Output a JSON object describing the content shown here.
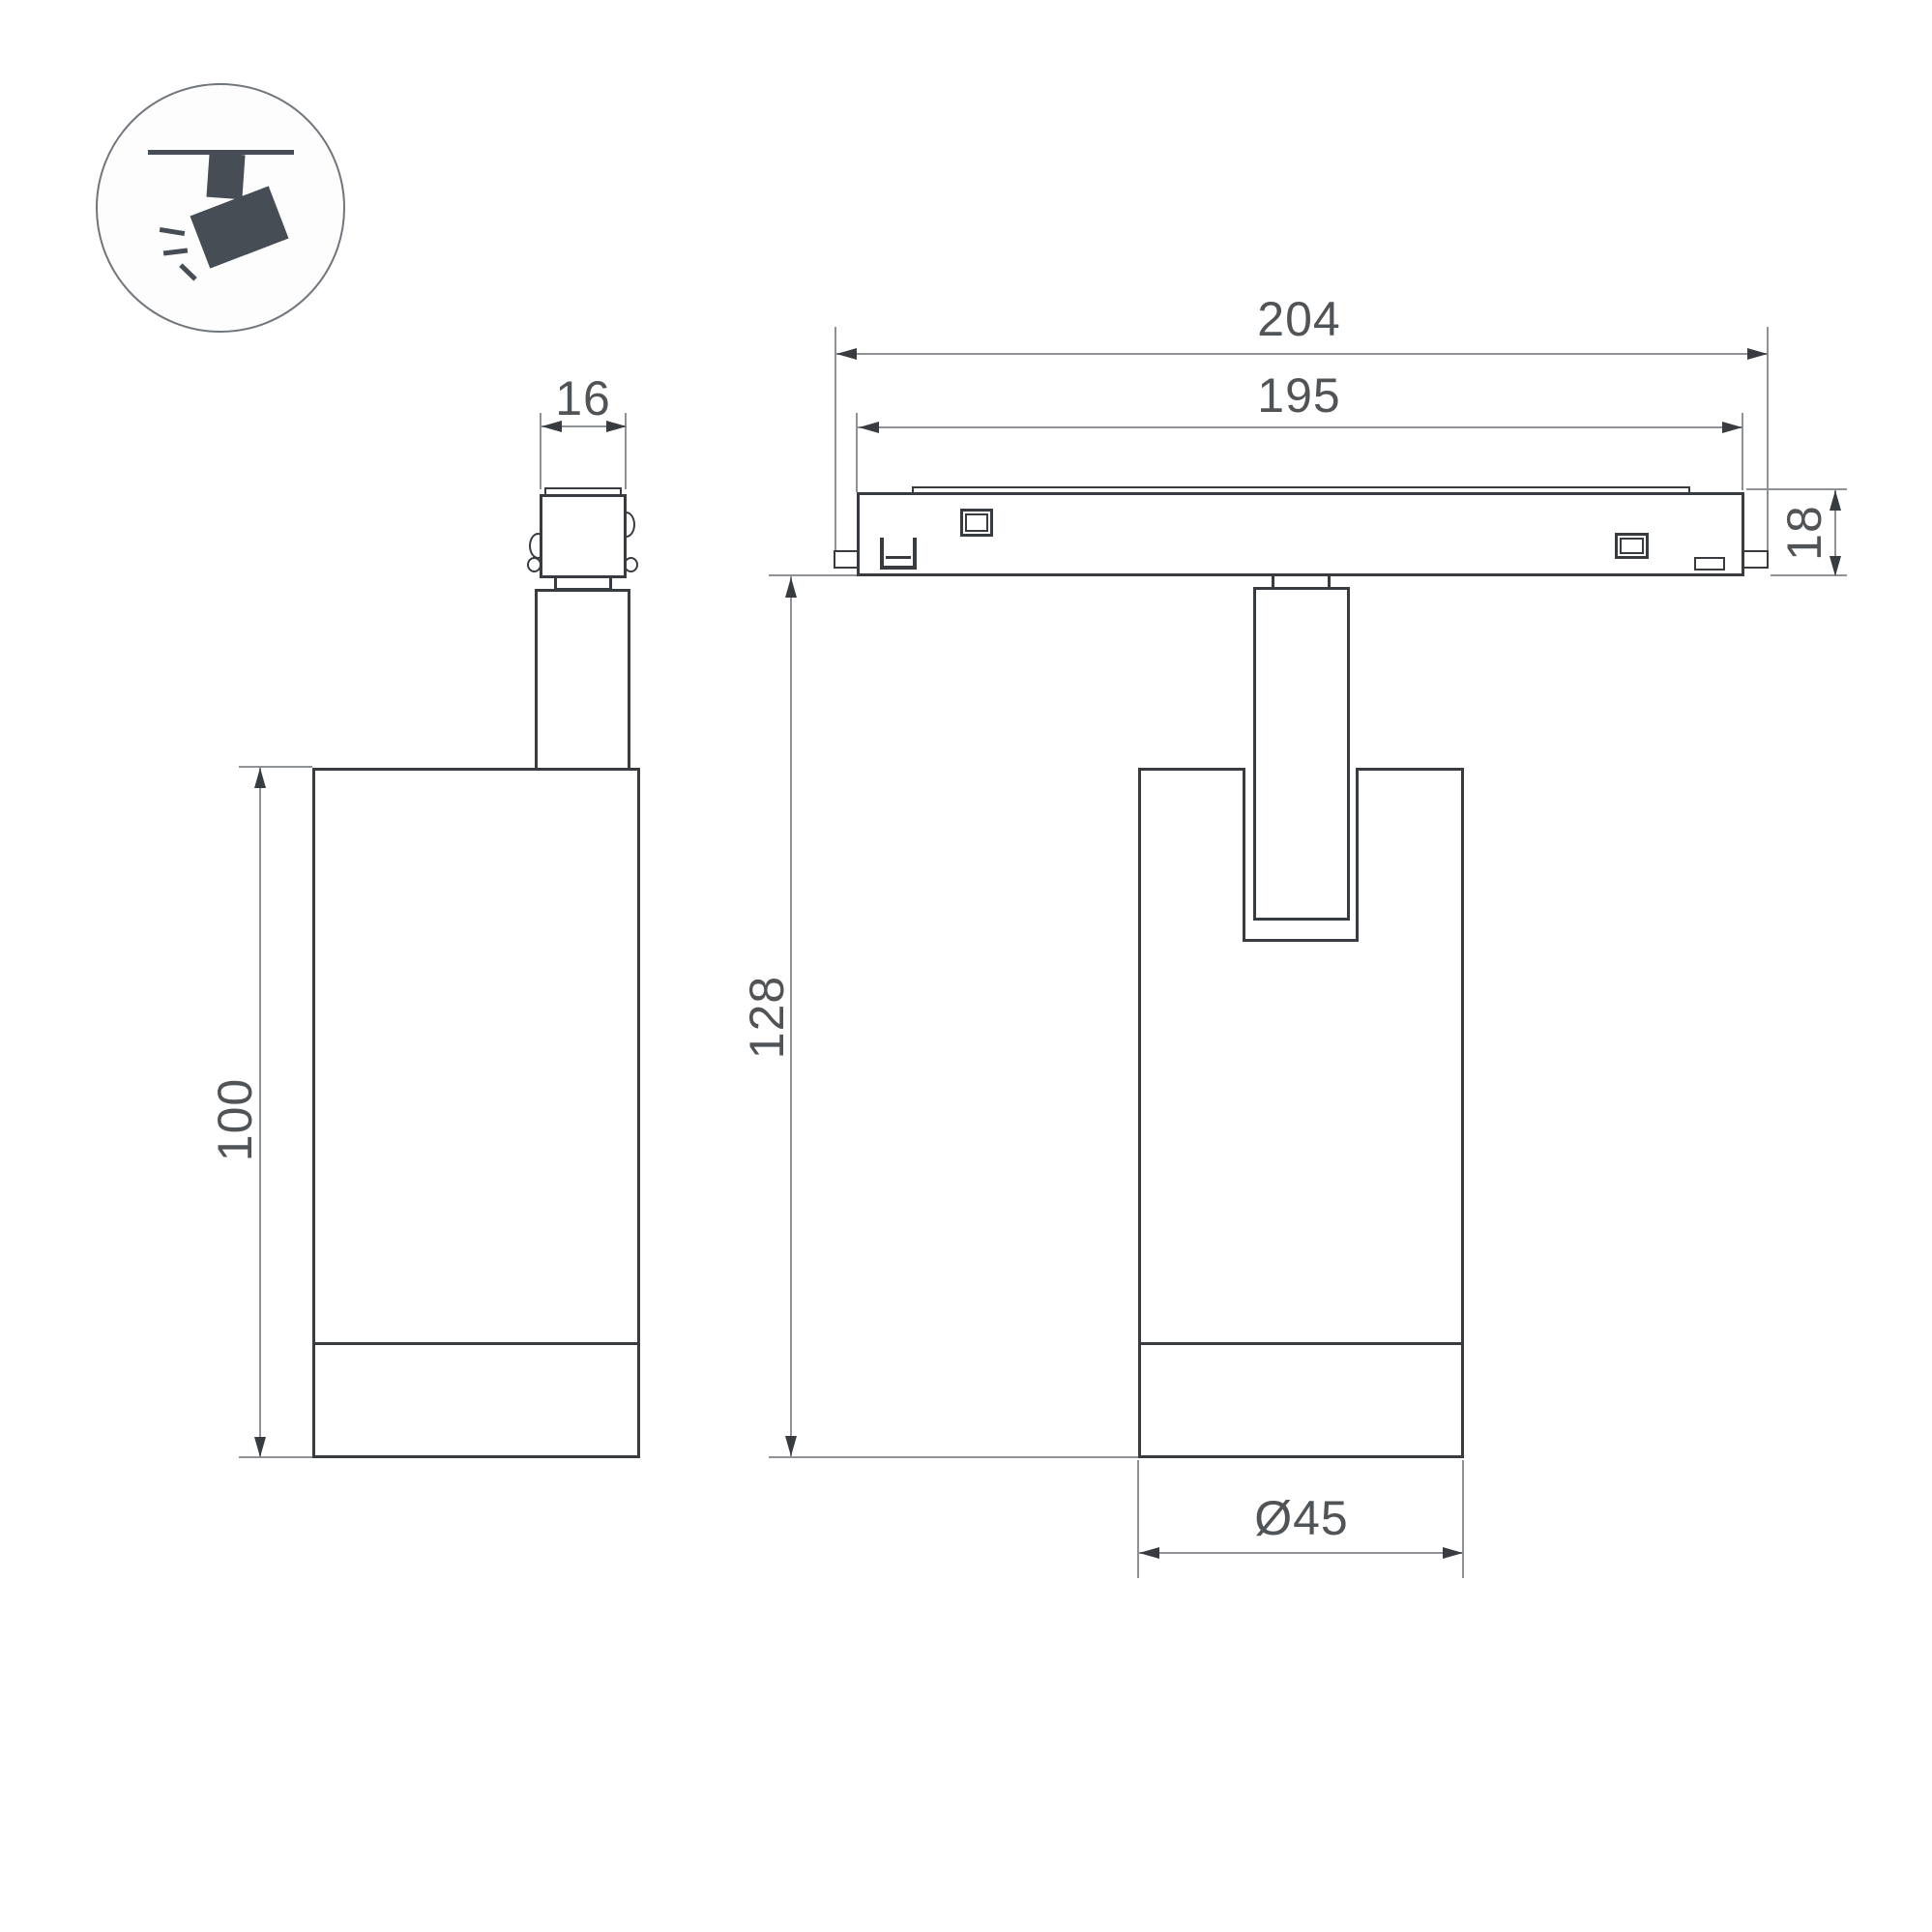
{
  "drawing": {
    "type": "technical-dimension-drawing",
    "subject": "track-mounted spotlight luminaire, two orthographic views",
    "colors": {
      "outline": "#383c41",
      "dimension_lines": "#8f9397",
      "dimension_text": "#515457",
      "icon": "#464d54",
      "background": "#ffffff"
    },
    "icon": {
      "name": "track-spotlight-pictogram",
      "description": "spotlight hanging from ceiling track, tilted, with light rays"
    },
    "dimensions": {
      "adapter_width": {
        "label": "16"
      },
      "body_height": {
        "label": "100"
      },
      "track_overall_length": {
        "label": "204"
      },
      "track_body_length": {
        "label": "195"
      },
      "track_height": {
        "label": "18"
      },
      "overall_height": {
        "label": "128"
      },
      "body_diameter": {
        "label": "Ø45"
      }
    }
  }
}
